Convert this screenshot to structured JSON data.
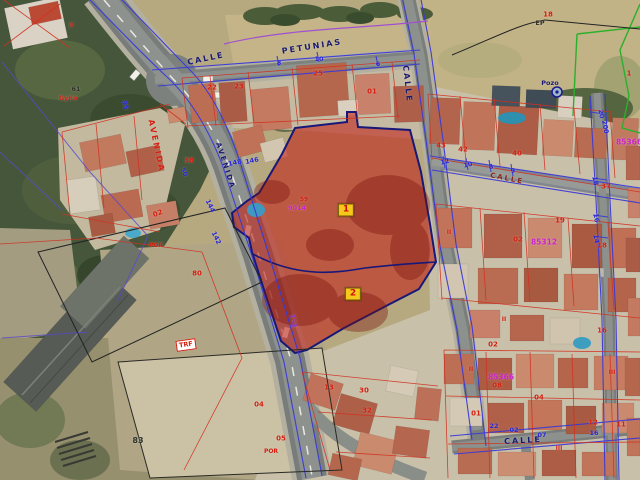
{
  "map": {
    "type": "aerial-cadastral-map",
    "colors": {
      "navy": "#1a1a70",
      "red": "#d42010",
      "blue": "#2828d8",
      "magenta": "#cc22cc",
      "dark": "#33332a",
      "darkred": "#8a2418",
      "purple": "#8833cc"
    },
    "labels": [
      {
        "t": "CALLE",
        "x": 206,
        "y": 59,
        "c": "navy",
        "r": -12,
        "cls": "st",
        "n": "street-name-calle-west"
      },
      {
        "t": "PETUNIAS",
        "x": 312,
        "y": 47,
        "c": "navy",
        "r": -9,
        "cls": "st",
        "n": "street-name-petunias"
      },
      {
        "t": "CALLE",
        "x": 407,
        "y": 84,
        "c": "navy",
        "r": 84,
        "cls": "st",
        "n": "street-name-calle-east"
      },
      {
        "t": "AVENIDA",
        "x": 156,
        "y": 146,
        "c": "red",
        "r": 78,
        "cls": "st",
        "n": "street-name-avenida-red"
      },
      {
        "t": "AVENIDA",
        "x": 225,
        "y": 166,
        "c": "navy",
        "r": 72,
        "s": 7,
        "cls": "st",
        "n": "street-name-avenida"
      },
      {
        "t": "CALLE",
        "x": 507,
        "y": 179,
        "c": "darkred",
        "r": 11,
        "s": 7,
        "cls": "st",
        "n": "street-name-calle-mid"
      },
      {
        "t": "CALLE",
        "x": 523,
        "y": 441,
        "c": "navy",
        "r": -3,
        "cls": "st",
        "n": "street-name-calle-south"
      },
      {
        "t": "22",
        "x": 212,
        "y": 88,
        "c": "red"
      },
      {
        "t": "23",
        "x": 239,
        "y": 87,
        "c": "red"
      },
      {
        "t": "25",
        "x": 318,
        "y": 74,
        "c": "red"
      },
      {
        "t": "01",
        "x": 372,
        "y": 92,
        "c": "red"
      },
      {
        "t": "38",
        "x": 189,
        "y": 161,
        "c": "red"
      },
      {
        "t": "02",
        "x": 158,
        "y": 214,
        "c": "red",
        "r": -20
      },
      {
        "t": "80",
        "x": 197,
        "y": 274,
        "c": "red"
      },
      {
        "t": "83",
        "x": 138,
        "y": 441,
        "c": "dark",
        "s": 8
      },
      {
        "t": "04",
        "x": 259,
        "y": 405,
        "c": "red"
      },
      {
        "t": "05",
        "x": 281,
        "y": 439,
        "c": "red"
      },
      {
        "t": "POR",
        "x": 156,
        "y": 246,
        "c": "red",
        "s": 6
      },
      {
        "t": "POR",
        "x": 271,
        "y": 452,
        "c": "red",
        "s": 6
      },
      {
        "t": "43",
        "x": 441,
        "y": 146,
        "c": "red"
      },
      {
        "t": "42",
        "x": 463,
        "y": 150,
        "c": "red"
      },
      {
        "t": "40",
        "x": 517,
        "y": 154,
        "c": "red"
      },
      {
        "t": "19",
        "x": 560,
        "y": 221,
        "c": "red"
      },
      {
        "t": "37",
        "x": 606,
        "y": 187,
        "c": "red"
      },
      {
        "t": "02",
        "x": 518,
        "y": 240,
        "c": "red"
      },
      {
        "t": "18",
        "x": 548,
        "y": 15,
        "c": "red"
      },
      {
        "t": "1",
        "x": 629,
        "y": 74,
        "c": "red"
      },
      {
        "t": "18",
        "x": 602,
        "y": 246,
        "c": "red"
      },
      {
        "t": "16",
        "x": 602,
        "y": 331,
        "c": "red"
      },
      {
        "t": "02",
        "x": 493,
        "y": 345,
        "c": "red"
      },
      {
        "t": "08",
        "x": 497,
        "y": 386,
        "c": "red"
      },
      {
        "t": "04",
        "x": 539,
        "y": 398,
        "c": "red"
      },
      {
        "t": "13",
        "x": 329,
        "y": 388,
        "c": "red"
      },
      {
        "t": "30",
        "x": 364,
        "y": 391,
        "c": "red"
      },
      {
        "t": "32",
        "x": 367,
        "y": 411,
        "c": "red"
      },
      {
        "t": "12",
        "x": 593,
        "y": 423,
        "c": "red"
      },
      {
        "t": "11",
        "x": 621,
        "y": 425,
        "c": "red"
      },
      {
        "t": "01",
        "x": 476,
        "y": 414,
        "c": "red"
      },
      {
        "t": "II",
        "x": 71,
        "y": 26,
        "c": "red",
        "s": 6
      },
      {
        "t": "II",
        "x": 449,
        "y": 233,
        "c": "red",
        "s": 6
      },
      {
        "t": "II",
        "x": 504,
        "y": 320,
        "c": "red",
        "s": 6
      },
      {
        "t": "II",
        "x": 471,
        "y": 370,
        "c": "red",
        "s": 6
      },
      {
        "t": "III",
        "x": 612,
        "y": 373,
        "c": "red",
        "s": 6
      },
      {
        "t": "III",
        "x": 559,
        "y": 449,
        "c": "red",
        "s": 6
      },
      {
        "t": "59",
        "x": 304,
        "y": 200,
        "c": "red",
        "s": 6
      },
      {
        "t": "Gy6o",
        "x": 68,
        "y": 98,
        "c": "red",
        "s": 6.5
      },
      {
        "t": "61",
        "x": 76,
        "y": 89,
        "c": "dark",
        "s": 6.5
      },
      {
        "t": "EP",
        "x": 540,
        "y": 23,
        "c": "dark",
        "s": 6.5
      },
      {
        "t": "Pozo",
        "x": 550,
        "y": 83,
        "c": "navy",
        "s": 6.5
      },
      {
        "t": "TRF",
        "x": 186,
        "y": 345,
        "c": "red",
        "r": -8,
        "s": 6.5,
        "cls": "boxed",
        "n": "transformer-label"
      },
      {
        "t": "95",
        "x": 125,
        "y": 105,
        "c": "blue",
        "r": 75,
        "s": 6.5
      },
      {
        "t": "50",
        "x": 184,
        "y": 172,
        "c": "blue",
        "r": 70,
        "s": 6.5
      },
      {
        "t": "148",
        "x": 235,
        "y": 163,
        "c": "blue",
        "r": -12,
        "s": 6.5
      },
      {
        "t": "146",
        "x": 252,
        "y": 161,
        "c": "blue",
        "r": -12,
        "s": 6.5
      },
      {
        "t": "144",
        "x": 210,
        "y": 206,
        "c": "blue",
        "r": 65,
        "s": 6.5
      },
      {
        "t": "142",
        "x": 216,
        "y": 238,
        "c": "blue",
        "r": 65,
        "s": 6.5
      },
      {
        "t": "8",
        "x": 279,
        "y": 63,
        "c": "blue",
        "s": 6.5
      },
      {
        "t": "10",
        "x": 319,
        "y": 59,
        "c": "blue",
        "s": 6.5
      },
      {
        "t": "6",
        "x": 378,
        "y": 64,
        "c": "blue",
        "s": 6.5
      },
      {
        "t": "12",
        "x": 445,
        "y": 162,
        "c": "blue",
        "r": -14,
        "s": 6.5
      },
      {
        "t": "10",
        "x": 468,
        "y": 165,
        "c": "blue",
        "r": -14,
        "s": 6.5
      },
      {
        "t": "8",
        "x": 491,
        "y": 167,
        "c": "blue",
        "r": -14,
        "s": 6.5
      },
      {
        "t": "9",
        "x": 513,
        "y": 171,
        "c": "blue",
        "r": -14,
        "s": 6.5
      },
      {
        "t": "20",
        "x": 601,
        "y": 114,
        "c": "blue",
        "r": 80,
        "s": 6.5
      },
      {
        "t": "200",
        "x": 605,
        "y": 127,
        "c": "blue",
        "r": 80,
        "s": 6.5
      },
      {
        "t": "18",
        "x": 595,
        "y": 181,
        "c": "blue",
        "r": 80,
        "s": 6.5
      },
      {
        "t": "16",
        "x": 596,
        "y": 218,
        "c": "blue",
        "r": 80,
        "s": 6.5
      },
      {
        "t": "14",
        "x": 596,
        "y": 239,
        "c": "blue",
        "r": 80,
        "s": 6.5
      },
      {
        "t": "22",
        "x": 494,
        "y": 426,
        "c": "blue",
        "s": 6.5
      },
      {
        "t": "02",
        "x": 514,
        "y": 430,
        "c": "blue",
        "s": 6.5
      },
      {
        "t": "07",
        "x": 542,
        "y": 435,
        "c": "blue",
        "s": 6.5
      },
      {
        "t": "16",
        "x": 594,
        "y": 433,
        "c": "blue",
        "s": 6.5
      },
      {
        "t": "85366",
        "x": 501,
        "y": 377,
        "c": "magenta",
        "s": 7.5,
        "n": "block-code"
      },
      {
        "t": "85312",
        "x": 544,
        "y": 242,
        "c": "magenta",
        "s": 7.5,
        "n": "block-code"
      },
      {
        "t": "85366",
        "x": 629,
        "y": 142,
        "c": "magenta",
        "s": 7.5,
        "n": "block-code"
      },
      {
        "t": "9014",
        "x": 297,
        "y": 208,
        "c": "magenta",
        "s": 6.5,
        "n": "block-code"
      },
      {
        "t": "153",
        "x": 293,
        "y": 321,
        "c": "purple",
        "r": 80,
        "s": 6.5
      }
    ],
    "markers": [
      {
        "label": "1",
        "x": 346,
        "y": 210
      },
      {
        "label": "2",
        "x": 353,
        "y": 294
      }
    ],
    "well": {
      "label": "Pozo",
      "x": 557,
      "y": 92
    }
  }
}
